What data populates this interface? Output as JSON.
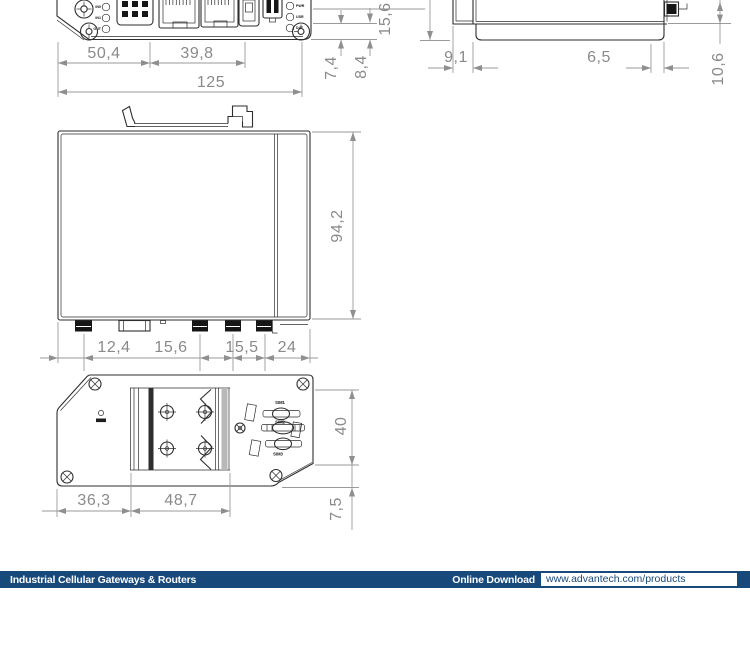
{
  "views": {
    "front": {
      "io_leds": [
        "IN0",
        "IN1",
        "OUT"
      ],
      "status_leds": [
        "PWR",
        "USR",
        "DAT"
      ],
      "dims": {
        "w1": "50,4",
        "w2": "39,8",
        "total": "125",
        "o1": "7,4",
        "o2": "8,4"
      }
    },
    "side": {
      "dims": {
        "h": "15,6",
        "d1": "9,1",
        "d2": "6,5",
        "v": "10,6"
      }
    },
    "profile": {
      "dims": {
        "height": "94,2",
        "b1": "12,4",
        "b2": "15,6",
        "b3": "15,5",
        "b4": "24"
      }
    },
    "bottom": {
      "sim_labels": [
        "SIM1",
        "SIM2",
        "SIM3"
      ],
      "dims": {
        "left": "36,3",
        "plate": "48,7",
        "h": "40",
        "o": "7,5"
      }
    }
  },
  "footer": {
    "category_label": "Industrial Cellular Gateways & Routers",
    "download_label": "Online Download",
    "download_url": "www.advantech.com/products"
  },
  "colors": {
    "footer_bar": "#17497b",
    "part_outline": "#2e2e2e",
    "dimension": "#8f8f8f"
  }
}
